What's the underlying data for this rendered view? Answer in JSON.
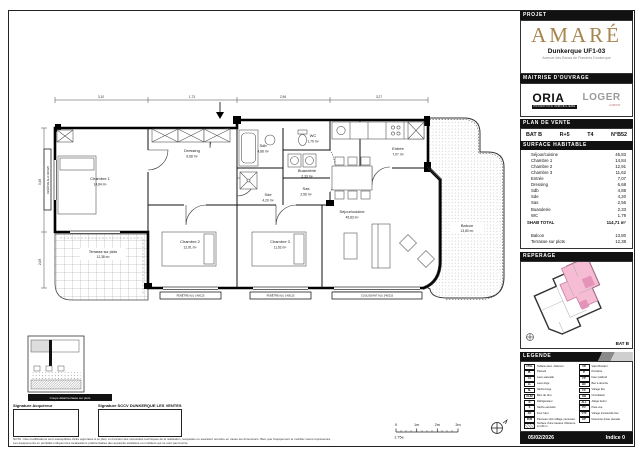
{
  "project": {
    "section_label": "PROJET",
    "brand": "AMARÉ",
    "unit_title": "Dunkerque UF1-03",
    "address": "Avenue des Bancs de Flandres Dunkerque"
  },
  "moa": {
    "section_label": "MAITRISE D'OUVRAGE",
    "logo1": "ORIA",
    "logo1_sub": "PROMOTION IMMOBILIERE",
    "logo2": "LOGER",
    "logo2_sub": "HABITAT"
  },
  "plan_vente": {
    "section_label": "PLAN DE VENTE",
    "bat": "BAT B",
    "etage": "R+5",
    "type": "T4",
    "numero": "N°B52"
  },
  "surfaces": {
    "section_label": "SURFACE HABITABLE",
    "rows": [
      {
        "label": "Séjour/cuisine",
        "value": "45,83"
      },
      {
        "label": "Chambre 1",
        "value": "14,84"
      },
      {
        "label": "Chambre 2",
        "value": "12,91"
      },
      {
        "label": "Chambre 3",
        "value": "11,62"
      },
      {
        "label": "Entrée",
        "value": "7,07"
      },
      {
        "label": "Dressing",
        "value": "6,68"
      },
      {
        "label": "Sdb",
        "value": "4,88"
      },
      {
        "label": "Sde",
        "value": "4,20"
      },
      {
        "label": "Sas",
        "value": "2,56"
      },
      {
        "label": "Buanderie",
        "value": "2,33"
      },
      {
        "label": "WC",
        "value": "1,79"
      }
    ],
    "total_label": "SHAB TOTAL",
    "total_value": "114,71 m²",
    "annexes": [
      {
        "label": "Balcon",
        "value": "13,80"
      },
      {
        "label": "Terrasse sur plots",
        "value": "12,38"
      }
    ]
  },
  "reperage": {
    "section_label": "REPERAGE",
    "bat_label": "BAT B"
  },
  "legende": {
    "section_label": "LEGENDE",
    "left": [
      {
        "abbr": "VTEL",
        "label": "Tableau élec. /télécom."
      },
      {
        "abbr": "PL",
        "label": "Placard"
      },
      {
        "abbr": "LV",
        "label": "Lave-vaisselle"
      },
      {
        "abbr": "LL",
        "label": "Lave-linge"
      },
      {
        "abbr": "SL",
        "label": "Sèche-linge"
      },
      {
        "abbr": "CLIM",
        "label": "Bloc de clim."
      },
      {
        "abbr": "R",
        "label": "Réfrigérateur"
      },
      {
        "abbr": "S",
        "label": "Sèche-serviette"
      },
      {
        "abbr": "FO",
        "label": "Four haut"
      },
      {
        "abbr": "PvM",
        "label": "Panneau vitré /Allège menuisée"
      },
      {
        "abbr": "",
        "label": "Surface d'une hauteur inférieure à 1,80 m"
      }
    ],
    "right": [
      {
        "abbr": "VR",
        "label": "Volet Roulant"
      },
      {
        "abbr": "P",
        "label": "Penderie"
      },
      {
        "abbr": "FP",
        "label": "Faux plafond"
      },
      {
        "abbr": "BC",
        "label": "Bac à douche"
      },
      {
        "abbr": "FX",
        "label": "Vitrage fixe"
      },
      {
        "abbr": "OB",
        "label": "Occultation"
      },
      {
        "abbr": "ALL",
        "label": "Allège béton"
      },
      {
        "abbr": "PV",
        "label": "Pare-vue"
      },
      {
        "abbr": "VTP",
        "label": "Vitrage translucide fixe"
      },
      {
        "abbr": "EP",
        "label": "Descente d'eau pluviale"
      }
    ]
  },
  "footer": {
    "date": "05/02/2026",
    "indice": "Indice 0"
  },
  "plan": {
    "rooms": {
      "chambre1": {
        "name": "Chambre 1",
        "area": "14,84 m²"
      },
      "dressing": {
        "name": "Dressing",
        "area": "6,68 m²"
      },
      "sdb": {
        "name": "Sdb",
        "area": "4,88 m²"
      },
      "wc": {
        "name": "WC",
        "area": "1,79 m²"
      },
      "buanderie": {
        "name": "Buanderie",
        "area": "2,33 m²"
      },
      "sas": {
        "name": "Sas",
        "area": "2,56 m²"
      },
      "sde": {
        "name": "Sde",
        "area": "4,20 m²"
      },
      "entree": {
        "name": "Entrée",
        "area": "7,07 m²"
      },
      "chambre2": {
        "name": "Chambre 2",
        "area": "12,91 m²"
      },
      "chambre3": {
        "name": "Chambre 3",
        "area": "11,62 m²"
      },
      "sejour": {
        "name": "Séjour/cuisine",
        "area": "45,83 m²"
      },
      "balcon": {
        "name": "Balcon",
        "area": "13,80 m²"
      },
      "terrasse": {
        "name": "Terrasse sur plots",
        "area": "12,38 m²"
      }
    },
    "windows": [
      "FENÊTRE ALU 140/125",
      "FENÊTRE ALU 140/125",
      "COULISSANT ALU 240/215",
      "FENÊTRE ALU 140/125"
    ],
    "dims": {
      "top": [
        "3,10",
        "1,73",
        "2,96",
        "3,27"
      ],
      "left": [
        "3,46",
        "2,08"
      ]
    },
    "detail_caption": "Coupe détail terrasse sur plots",
    "scale": {
      "ratio": "1:75e",
      "ticks": [
        "0",
        "1m",
        "2m",
        "3m"
      ]
    }
  },
  "signatures": {
    "buyer_label": "Signature Acquéreur",
    "seller_label": "Signature SCCV DUNKERQUE LES VENTES"
  },
  "nota": {
    "line1": "NOTA : Des modifications sont susceptibles d'être apportées à ce plan, en fonction des nécessités techniques de la réalisation, lesquelles ne sauraient remettre en cause les dimensions. Bien que l'équipement et mobilier soient représentés,",
    "line2": "Les équipements en pointillés indiquent les localisations préférentielles des appareils sanitaires ou mobiliers qui ne sont pas fournis."
  }
}
